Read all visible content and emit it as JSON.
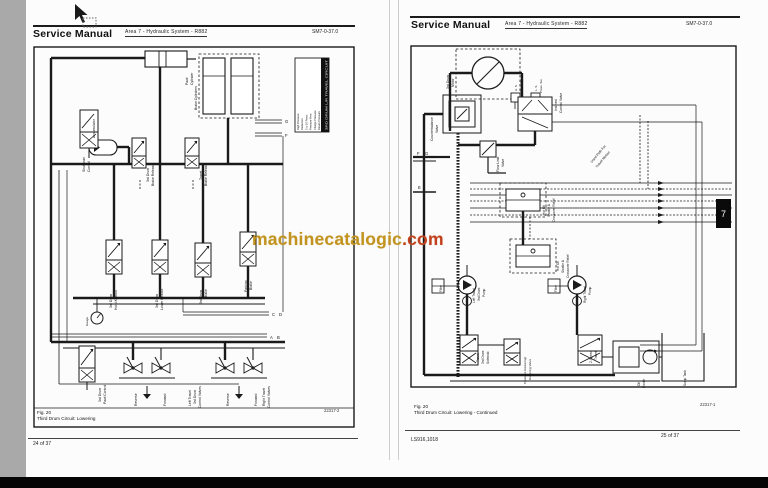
{
  "viewer": {
    "left_strip_color": "#a9a9a9",
    "bottom_bar_color": "#050505",
    "tab_marker": "7"
  },
  "watermark": {
    "text_main": "machinecatalogic",
    "text_suffix": ".com",
    "color_main": "#c2941f",
    "color_suffix": "#c2401f"
  },
  "left_page": {
    "header": {
      "title": "Service Manual",
      "area": "Area 7 - Hydraulic System - R882",
      "code": "SM7-0-37.0"
    },
    "caption": {
      "fig": "Fig. 20",
      "title": "Third Drum Circuit: Lowering",
      "code": "22317-2"
    },
    "footer": {
      "page": "24 of 37"
    },
    "legend": {
      "header": "3RD DRUM L/R TRAVEL CIRCUIT",
      "rows": [
        "High Pressure",
        "Reduction",
        "3 to 10 Press",
        "Pressure Free",
        "Charge Pressure",
        "Return Pressure"
      ]
    },
    "labels": [
      [
        "Pawl",
        155,
        39,
        -90,
        3.4
      ],
      [
        "Cylinder",
        160,
        39,
        -90,
        3.4
      ],
      [
        "Accumulator",
        62,
        92,
        -90,
        3.4
      ],
      [
        "Brake Cylinders",
        164,
        64,
        -90,
        3.4
      ],
      [
        "Shutdown",
        52,
        126,
        -90,
        3.4
      ],
      [
        "Control",
        57,
        126,
        -90,
        3.4
      ],
      [
        "3rd Drum",
        116,
        136,
        -90,
        3.4
      ],
      [
        "Brake Release",
        121,
        140,
        -90,
        3.4
      ],
      [
        "Travel",
        169,
        134,
        -90,
        3.4
      ],
      [
        "Brake Release",
        174,
        140,
        -90,
        3.4
      ],
      [
        "3rd Drum",
        79,
        262,
        -90,
        3.4
      ],
      [
        "Hoist Kickout",
        84,
        264,
        -90,
        3.4
      ],
      [
        "3rd Drum",
        125,
        262,
        -90,
        3.4
      ],
      [
        "Lower Kickout",
        130,
        264,
        -90,
        3.4
      ],
      [
        "3rd Drum",
        169,
        258,
        -90,
        3.4
      ],
      [
        "Brake",
        174,
        252,
        -90,
        3.4
      ],
      [
        "Parking",
        214,
        246,
        -90,
        3.4
      ],
      [
        "Brake",
        219,
        244,
        -90,
        3.4
      ],
      [
        "Gauge",
        55,
        280,
        -90,
        3.0
      ],
      [
        "G",
        252,
        77,
        0,
        4.2
      ],
      [
        "F",
        252,
        91,
        0,
        4.2
      ],
      [
        "C",
        239,
        270,
        0,
        4.2
      ],
      [
        "D",
        246,
        270,
        0,
        4.2
      ],
      [
        "A",
        237,
        293,
        0,
        4.2
      ],
      [
        "B",
        244,
        293,
        0,
        4.2
      ],
      [
        "3rd Drum",
        68,
        356,
        -90,
        3.4
      ],
      [
        "Pawl Control",
        73,
        358,
        -90,
        3.4
      ],
      [
        "Reverse",
        104,
        360,
        -90,
        3.4
      ],
      [
        "Forward",
        133,
        360,
        -90,
        3.4
      ],
      [
        "Left Travel",
        158,
        360,
        -90,
        3.4
      ],
      [
        "3rd Drum",
        163,
        358,
        -90,
        3.4
      ],
      [
        "Control Valves",
        168,
        362,
        -90,
        3.4
      ],
      [
        "Reverse",
        196,
        360,
        -90,
        3.4
      ],
      [
        "Forward",
        224,
        360,
        -90,
        3.4
      ],
      [
        "Right Travel",
        232,
        360,
        -90,
        3.4
      ],
      [
        "Control Valves",
        237,
        362,
        -90,
        3.4
      ]
    ]
  },
  "right_page": {
    "header": {
      "title": "Service Manual",
      "area": "Area 7 - Hydraulic System - R882",
      "code": "SM7-0-37.0"
    },
    "caption": {
      "fig": "Fig. 20",
      "title": "Third Drum Circuit: Lowering - Continued",
      "code": "22317-1"
    },
    "footer": {
      "code": "LS916,1018",
      "page": "25 of 37"
    },
    "labels": [
      [
        "3rd Drum",
        39,
        44,
        -90,
        3.4
      ],
      [
        "Motor",
        44,
        42,
        -90,
        3.4
      ],
      [
        "Counterbalance",
        23,
        96,
        -90,
        3.4
      ],
      [
        "Valve",
        28,
        88,
        -90,
        3.4
      ],
      [
        "H. S.",
        107,
        46,
        -90,
        3.0
      ],
      [
        "Press. Sw.",
        112,
        48,
        -90,
        3.0
      ],
      [
        "L. S.",
        127,
        46,
        -90,
        3.0
      ],
      [
        "Press. Sw.",
        132,
        48,
        -90,
        3.0
      ],
      [
        "Inclined",
        147,
        66,
        -90,
        3.4
      ],
      [
        "Control Valve",
        152,
        68,
        -90,
        3.4
      ],
      [
        "Flow Limit",
        89,
        127,
        -90,
        3.4
      ],
      [
        "Valve",
        94,
        122,
        -90,
        3.4
      ],
      [
        "F",
        7,
        110,
        0,
        4.2
      ],
      [
        "G",
        15,
        110,
        0,
        4.2
      ],
      [
        "E",
        8,
        144,
        0,
        4.2
      ],
      [
        "Used Path For",
        182,
        118,
        -50,
        3.4
      ],
      [
        "Travel Motion",
        187,
        123,
        -50,
        3.4
      ],
      [
        "Hot Oil",
        135,
        170,
        -90,
        3.2
      ],
      [
        "Shuttle &",
        140,
        172,
        -90,
        3.2
      ],
      [
        "Crossover Relief",
        145,
        177,
        -90,
        3.2
      ],
      [
        "Hot Oil",
        149,
        226,
        -90,
        3.2
      ],
      [
        "Shuttle &",
        154,
        228,
        -90,
        3.2
      ],
      [
        "Crossover Relief",
        159,
        233,
        -90,
        3.2
      ],
      [
        "Filter",
        32,
        247,
        -90,
        3.2
      ],
      [
        "Left Travel",
        65,
        258,
        -90,
        3.2
      ],
      [
        "3rd Drum",
        70,
        256,
        -90,
        3.2
      ],
      [
        "Pump",
        75,
        252,
        -90,
        3.2
      ],
      [
        "Filter",
        147,
        247,
        -90,
        3.2
      ],
      [
        "Right Travel",
        176,
        258,
        -90,
        3.2
      ],
      [
        "Pump",
        181,
        250,
        -90,
        3.2
      ],
      [
        "Travel",
        69,
        317,
        -90,
        3.2
      ],
      [
        "3rd Drum",
        74,
        319,
        -90,
        3.2
      ],
      [
        "Solenoid",
        79,
        319,
        -90,
        3.2
      ],
      [
        "Pressure Reducing/",
        116,
        339,
        -90,
        3.1
      ],
      [
        "Relieving Valve",
        121,
        335,
        -90,
        3.1
      ],
      [
        "2-Speed",
        182,
        318,
        -90,
        3.2
      ],
      [
        "Travel",
        187,
        315,
        -90,
        3.2
      ],
      [
        "Oil",
        230,
        341,
        -90,
        3.2
      ],
      [
        "Cooler",
        235,
        343,
        -90,
        3.2
      ],
      [
        "Sump Tank",
        276,
        341,
        -90,
        3.2
      ]
    ]
  }
}
